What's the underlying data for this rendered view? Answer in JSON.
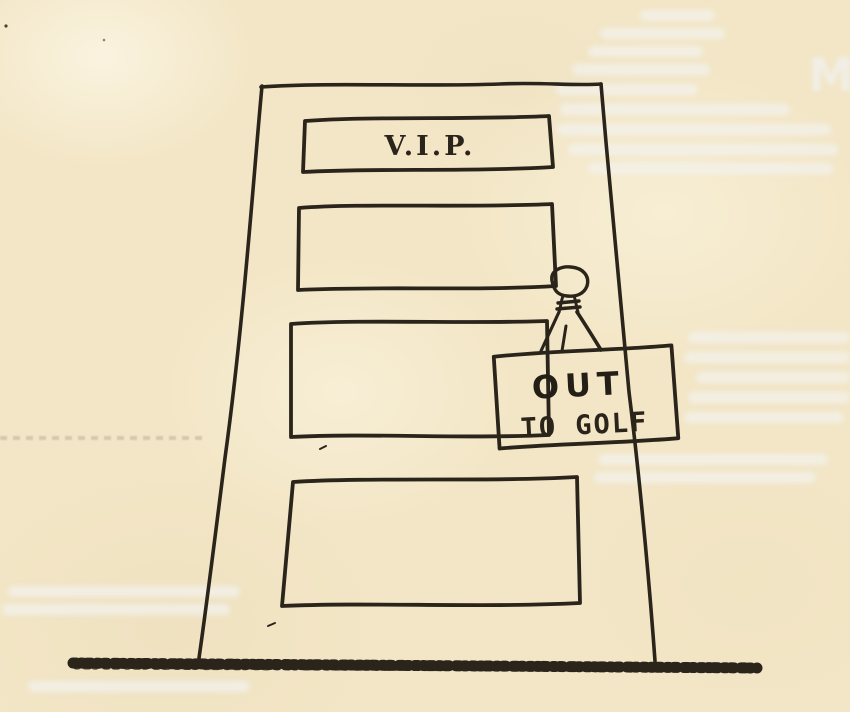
{
  "illustration": {
    "vip_sign_label": "V.I.P.",
    "hanging_sign": {
      "line1": "OUT",
      "line2": "TO GOLF"
    },
    "bleed_through_letter": "M"
  },
  "colors": {
    "paper": "#f3e6c6",
    "ink": "#2a241b",
    "sign_paper": "#f7eed6",
    "bleed_through": "#f0eee6"
  }
}
